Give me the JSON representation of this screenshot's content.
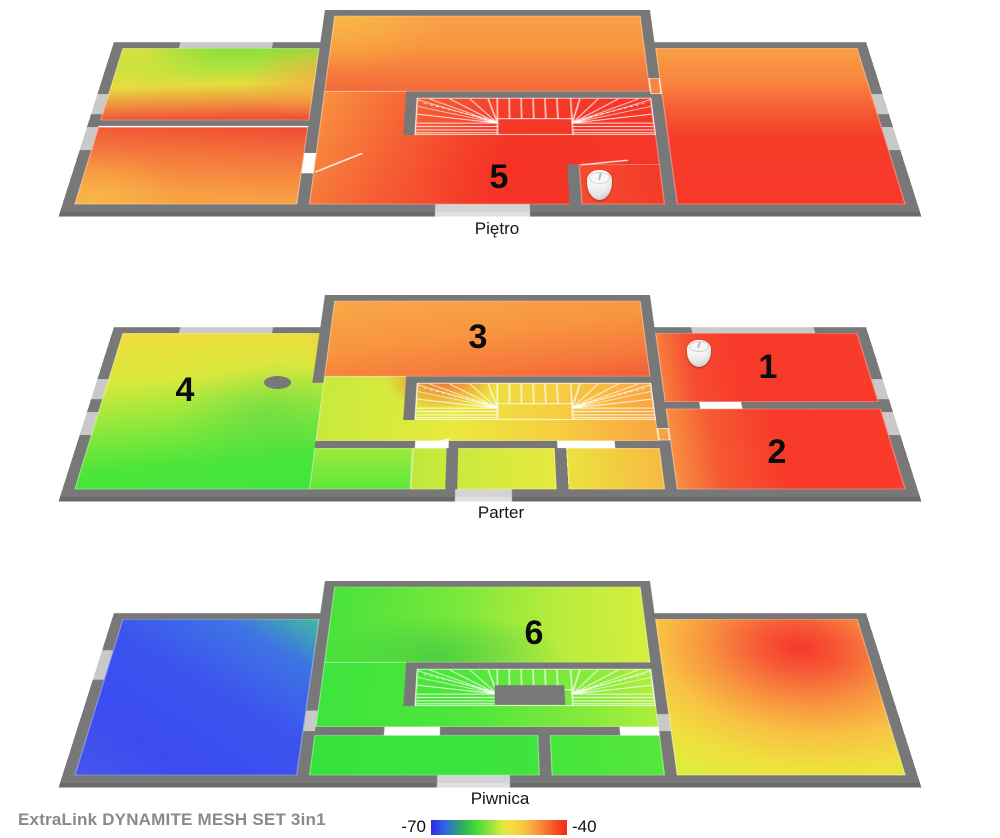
{
  "floors": [
    {
      "id": "pietro",
      "label": "Piętro",
      "markers": [
        {
          "label": "5"
        }
      ],
      "device_count": 1
    },
    {
      "id": "parter",
      "label": "Parter",
      "markers": [
        {
          "label": "1"
        },
        {
          "label": "2"
        },
        {
          "label": "3"
        },
        {
          "label": "4"
        }
      ],
      "device_count": 1
    },
    {
      "id": "piwnica",
      "label": "Piwnica",
      "markers": [
        {
          "label": "6"
        }
      ],
      "device_count": 0
    }
  ],
  "footer": {
    "brand": "ExtraLink DYNAMITE MESH SET  3in1"
  },
  "legend": {
    "min_label": "-70",
    "max_label": "-40"
  },
  "palette": {
    "wall": "#787878",
    "window": "#c9c9c9",
    "signal_strong": "#f83a2a",
    "signal_medium": "#e8e83c",
    "signal_weak": "#3c4ff0",
    "scale_start": "#2b2be0",
    "scale_end": "#ef2f15"
  }
}
